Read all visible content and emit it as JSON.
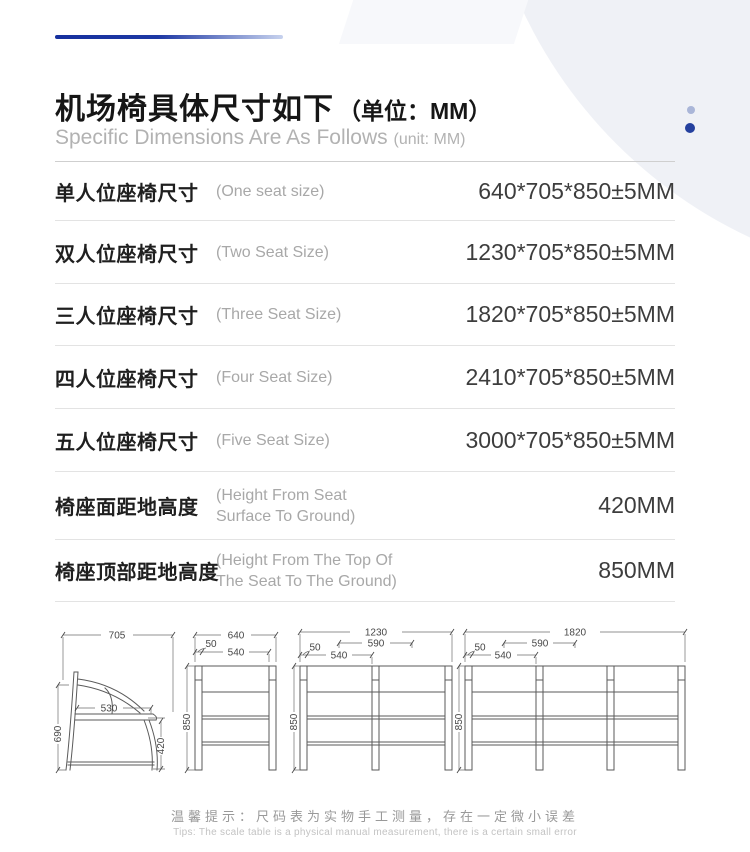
{
  "header": {
    "title_zh": "机场椅具体尺寸如下",
    "title_unit": "（单位：MM）",
    "subtitle_en": "Specific Dimensions Are As Follows",
    "subtitle_unit": "(unit: MM)"
  },
  "colors": {
    "accent_navy": "#24409e",
    "accent_dot_light": "#aab6d8",
    "divider": "#e3e3e3"
  },
  "table": {
    "rows": [
      {
        "zh": "单人位座椅尺寸",
        "en": "(One seat size)",
        "value": "640*705*850±5MM"
      },
      {
        "zh": "双人位座椅尺寸",
        "en": "(Two Seat Size)",
        "value": "1230*705*850±5MM"
      },
      {
        "zh": "三人位座椅尺寸",
        "en": "(Three Seat Size)",
        "value": "1820*705*850±5MM"
      },
      {
        "zh": "四人位座椅尺寸",
        "en": "(Four Seat Size)",
        "value": "2410*705*850±5MM"
      },
      {
        "zh": "五人位座椅尺寸",
        "en": "(Five Seat Size)",
        "value": "3000*705*850±5MM"
      },
      {
        "zh": "椅座面距地高度",
        "en1": "(Height From Seat",
        "en2": "Surface To Ground)",
        "value": "420MM"
      },
      {
        "zh": "椅座顶部距地高度",
        "en1": "(Height From The Top Of",
        "en2": "The Seat To The Ground)",
        "value": "850MM"
      }
    ]
  },
  "diagrams": {
    "side_view": {
      "total_depth": "705",
      "seat_depth": "530",
      "back_height": "690",
      "seat_height": "420"
    },
    "one_seat": {
      "total_width": "640",
      "armrest_width": "50",
      "seat_width": "540",
      "total_height": "850"
    },
    "two_seat": {
      "total_width": "1230",
      "seat_pitch": "590",
      "armrest_width": "50",
      "seat_width": "540",
      "total_height": "850"
    },
    "three_seat": {
      "total_width": "1820",
      "seat_pitch": "590",
      "armrest_width": "50",
      "seat_width": "540",
      "total_height": "850"
    }
  },
  "footer": {
    "tip_zh": "温馨提示：尺码表为实物手工测量，存在一定微小误差",
    "tip_en": "Tips: The scale table is a physical manual measurement, there is a certain small error"
  }
}
